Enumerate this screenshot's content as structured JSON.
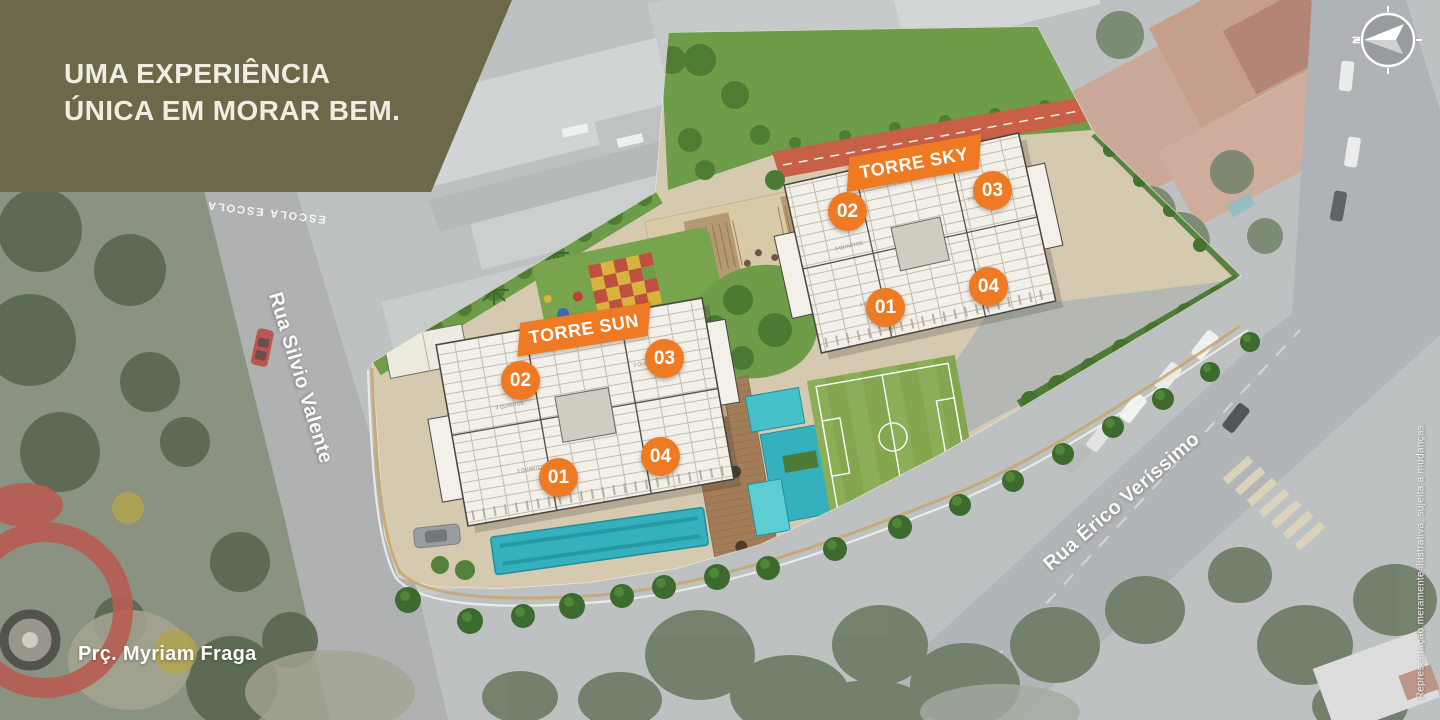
{
  "banner": {
    "line1": "UMA EXPERIÊNCIA",
    "line2": "ÚNICA EM MORAR BEM."
  },
  "compass": {
    "north": "N"
  },
  "towers": [
    {
      "name": "TORRE SKY",
      "units": [
        "01",
        "02",
        "03",
        "04"
      ]
    },
    {
      "name": "TORRE SUN",
      "units": [
        "01",
        "02",
        "03",
        "04"
      ]
    }
  ],
  "labels": {
    "street_left": "Rua Silvio Valente",
    "street_right": "Rua Érico Veríssimo",
    "square": "Prç. Myriam Fraga",
    "road_marking": "ESCOLA ESCOLA",
    "floorplan_room": "3 QUARTOS"
  },
  "disclaimer": "Representação meramente ilustrativa, sujeita a mudanças",
  "colors": {
    "accent_orange": "#ee7a23",
    "banner_olive": "#6c6849",
    "pool_teal": "#35b0bd",
    "lawn_green": "#6f9c48",
    "track_red": "#c85f47"
  }
}
